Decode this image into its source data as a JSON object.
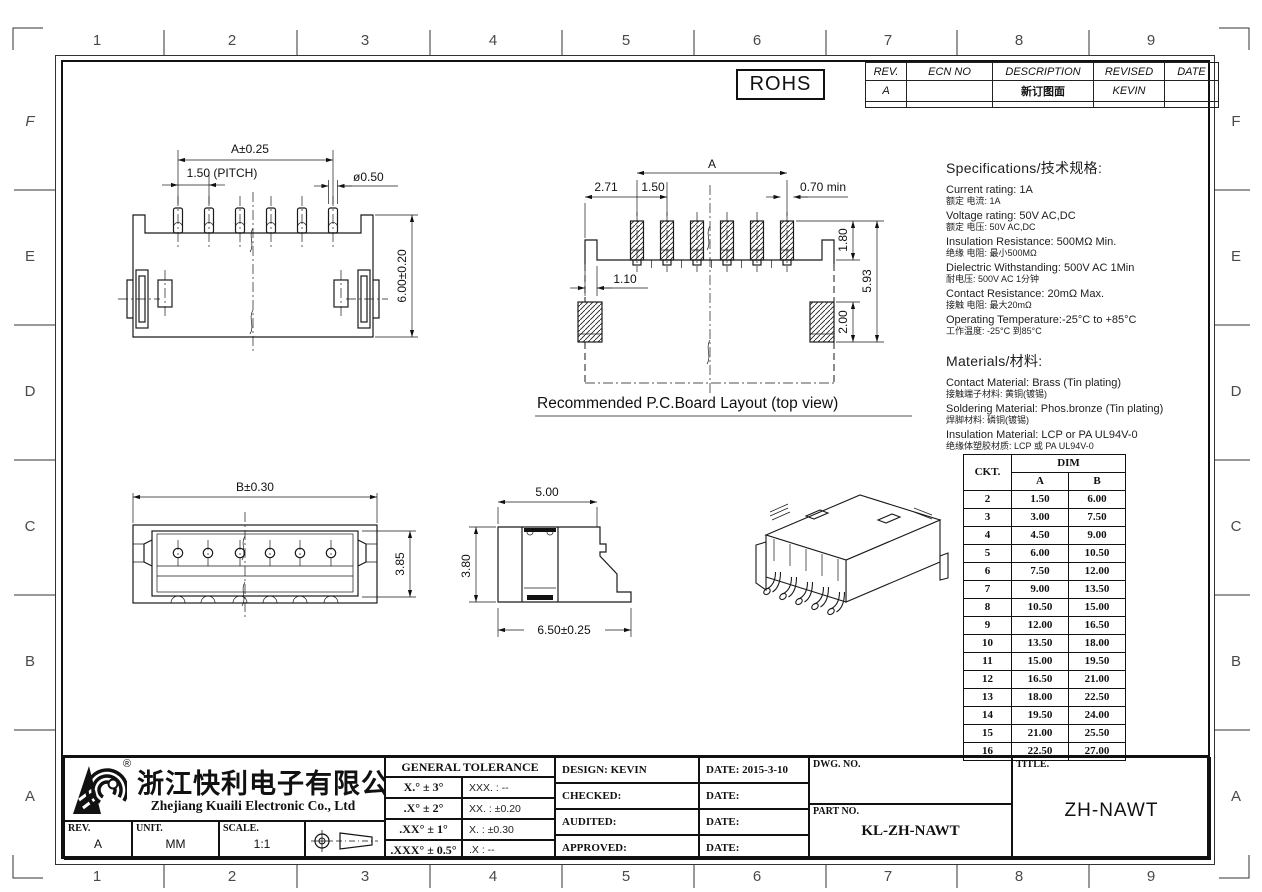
{
  "sheet": {
    "grid_columns": [
      "1",
      "2",
      "3",
      "4",
      "5",
      "6",
      "7",
      "8",
      "9"
    ],
    "grid_rows": [
      "F",
      "E",
      "D",
      "C",
      "B",
      "A"
    ],
    "rohs": "ROHS"
  },
  "revision_table": {
    "col_rev": "REV.",
    "col_ecn": "ECN  NO",
    "col_desc": "DESCRIPTION",
    "col_revised": "REVISED",
    "col_date": "DATE",
    "rows": [
      {
        "rev": "A",
        "ecn": "",
        "desc": "新订图面",
        "revised": "KEVIN",
        "date": ""
      }
    ]
  },
  "specifications": {
    "title": "Specifications/技术规格:",
    "items": [
      {
        "en": "Current  rating:  1A",
        "cn": "额定 电流: 1A"
      },
      {
        "en": "Voltage  rating:  50V  AC,DC",
        "cn": "额定 电压: 50V AC,DC"
      },
      {
        "en": "Insulation  Resistance:  500MΩ  Min.",
        "cn": "绝缘 电阻: 最小500MΩ"
      },
      {
        "en": "Dielectric  Withstanding:   500V  AC   1Min",
        "cn": "耐电压: 500V AC  1分钟"
      },
      {
        "en": "Contact  Resistance:   20mΩ  Max.",
        "cn": "接触 电阻: 最大20mΩ"
      },
      {
        "en": "Operating  Temperature:-25°C  to  +85°C",
        "cn": "工作温度: -25°C 到85°C"
      }
    ]
  },
  "materials": {
    "title": "Materials/材料:",
    "items": [
      {
        "en": "Contact  Material:  Brass  (Tin  plating)",
        "cn": "接触端子材料: 黄铜(镀锡)"
      },
      {
        "en": "Soldering  Material:  Phos.bronze  (Tin  plating)",
        "cn": "焊脚材料: 磷铜(镀锡)"
      },
      {
        "en": "Insulation  Material:  LCP  or  PA  UL94V-0",
        "cn": "绝缘体塑胶材质: LCP 或 PA UL94V-0"
      }
    ]
  },
  "dim_table": {
    "ckt": "CKT.",
    "dim": "DIM",
    "a": "A",
    "b": "B",
    "rows": [
      {
        "ckt": "2",
        "a": "1.50",
        "b": "6.00"
      },
      {
        "ckt": "3",
        "a": "3.00",
        "b": "7.50"
      },
      {
        "ckt": "4",
        "a": "4.50",
        "b": "9.00"
      },
      {
        "ckt": "5",
        "a": "6.00",
        "b": "10.50"
      },
      {
        "ckt": "6",
        "a": "7.50",
        "b": "12.00"
      },
      {
        "ckt": "7",
        "a": "9.00",
        "b": "13.50"
      },
      {
        "ckt": "8",
        "a": "10.50",
        "b": "15.00"
      },
      {
        "ckt": "9",
        "a": "12.00",
        "b": "16.50"
      },
      {
        "ckt": "10",
        "a": "13.50",
        "b": "18.00"
      },
      {
        "ckt": "11",
        "a": "15.00",
        "b": "19.50"
      },
      {
        "ckt": "12",
        "a": "16.50",
        "b": "21.00"
      },
      {
        "ckt": "13",
        "a": "18.00",
        "b": "22.50"
      },
      {
        "ckt": "14",
        "a": "19.50",
        "b": "24.00"
      },
      {
        "ckt": "15",
        "a": "21.00",
        "b": "25.50"
      },
      {
        "ckt": "16",
        "a": "22.50",
        "b": "27.00"
      }
    ]
  },
  "title_block": {
    "company_cn": "浙江快利电子有限公司",
    "company_en": "Zhejiang  Kuaili  Electronic  Co.,  Ltd",
    "reg_mark": "®",
    "rev_label": "REV.",
    "rev_value": "A",
    "unit_label": "UNIT.",
    "unit_value": "MM",
    "scale_label": "SCALE.",
    "scale_value": "1:1",
    "tolerance_title": "GENERAL  TOLERANCE",
    "tolerance_rows": [
      {
        "angle": "X.° ± 3°",
        "linear": "XXX. :   --"
      },
      {
        "angle": ".X° ± 2°",
        "linear": "XX. :   ±0.20"
      },
      {
        "angle": ".XX° ± 1°",
        "linear": "X.   :   ±0.30"
      },
      {
        "angle": ".XXX° ± 0.5°",
        "linear": ".X  :   --"
      }
    ],
    "approvals": [
      {
        "label": "DESIGN: KEVIN",
        "date": "DATE: 2015-3-10"
      },
      {
        "label": "CHECKED:",
        "date": "DATE:"
      },
      {
        "label": "AUDITED:",
        "date": "DATE:"
      },
      {
        "label": "APPROVED:",
        "date": "DATE:"
      }
    ],
    "dwg_no_label": "DWG. NO.",
    "part_no_label": "PART NO.",
    "part_no_value": "KL-ZH-NAWT",
    "title_label": "TITLE.",
    "title_value": "ZH-NAWT"
  },
  "views": {
    "pin_view": {
      "dim_a": "A±0.25",
      "dim_pitch": "1.50 (PITCH)",
      "dim_dia": "ø0.50",
      "dim_h": "6.00±0.20"
    },
    "pcb_view": {
      "caption": "Recommended  P.C.Board Layout  (top  view)",
      "dim_a": "A",
      "dim_271": "2.71",
      "dim_150": "1.50",
      "dim_070": "0.70  min",
      "dim_110": "1.10",
      "dim_180": "1.80",
      "dim_593": "5.93",
      "dim_200": "2.00"
    },
    "front_view": {
      "dim_b": "B±0.30",
      "dim_385": "3.85"
    },
    "side_view": {
      "dim_500": "5.00",
      "dim_380": "3.80",
      "dim_650": "6.50±0.25"
    }
  }
}
